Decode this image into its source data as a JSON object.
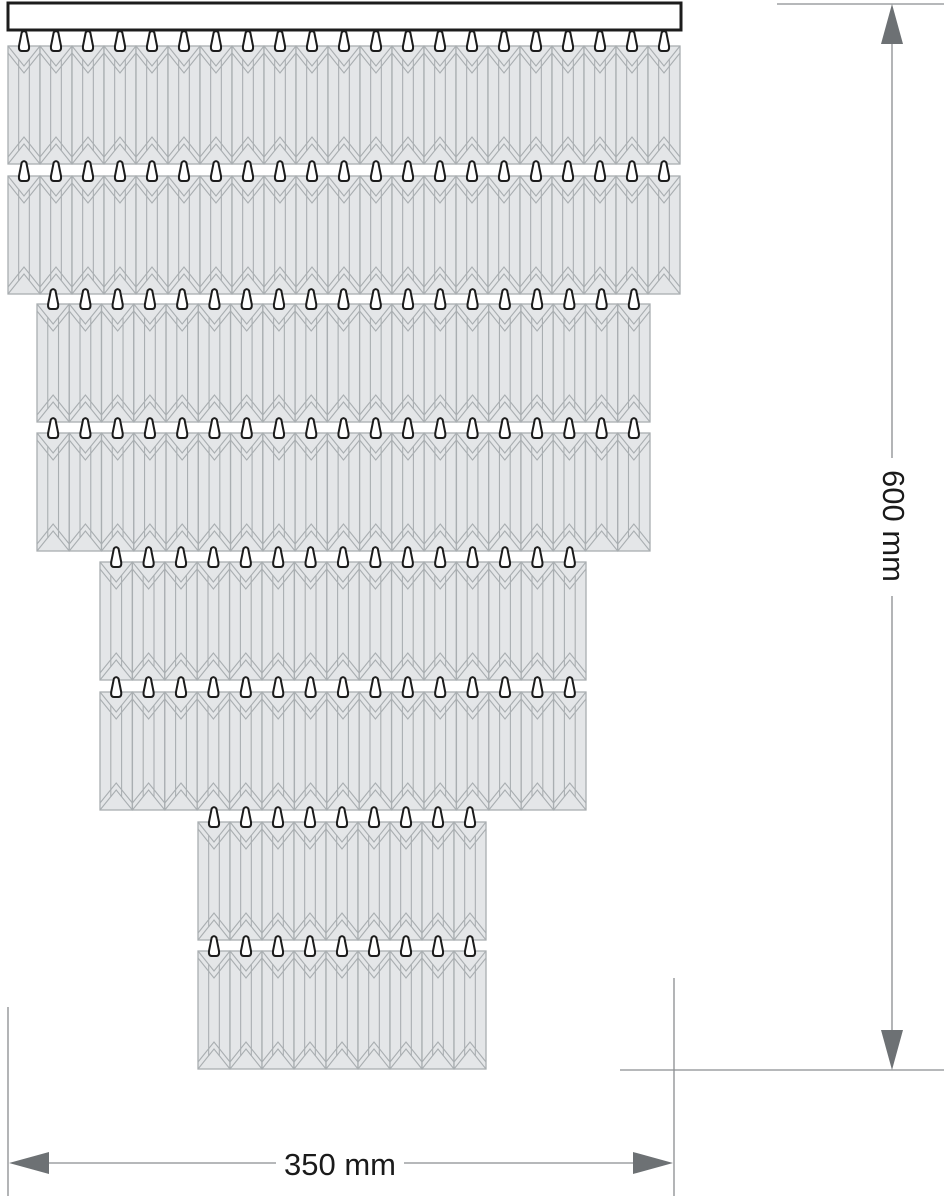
{
  "dimensions": {
    "height": {
      "label": "600 mm"
    },
    "width": {
      "label": "350 mm"
    }
  },
  "fixture": {
    "bar": {
      "x": 8,
      "y": 3,
      "width": 673,
      "height": 27
    },
    "prism_height": 118,
    "chevron_depth": 20,
    "chevron_inner_offset": 7,
    "hook_height": 21,
    "tiers": [
      {
        "row": 1,
        "prisms": 21,
        "left": 8,
        "width": 672,
        "top": 46
      },
      {
        "row": 2,
        "prisms": 21,
        "left": 8,
        "width": 672,
        "top": 176
      },
      {
        "row": 3,
        "prisms": 19,
        "left": 37,
        "width": 613,
        "top": 304
      },
      {
        "row": 4,
        "prisms": 19,
        "left": 37,
        "width": 613,
        "top": 433
      },
      {
        "row": 5,
        "prisms": 15,
        "left": 100,
        "width": 486,
        "top": 562
      },
      {
        "row": 6,
        "prisms": 15,
        "left": 100,
        "width": 486,
        "top": 692
      },
      {
        "row": 7,
        "prisms": 9,
        "left": 198,
        "width": 288,
        "top": 822
      },
      {
        "row": 8,
        "prisms": 9,
        "left": 198,
        "width": 288,
        "top": 951
      }
    ]
  },
  "annotations": {
    "height_dim": {
      "line_x": 892,
      "tip_top_y": 4,
      "tip_bottom_y": 1070,
      "ext_top": {
        "x1": 777,
        "x2": 944,
        "y": 4
      },
      "ext_bottom": {
        "x1": 620,
        "x2": 944,
        "y": 1070
      },
      "label_center": {
        "x": 894,
        "y": 526
      },
      "label_gap": [
        458,
        596
      ]
    },
    "width_dim": {
      "line_y": 1163,
      "tip_left_x": 9,
      "tip_right_x": 673,
      "ext_left": {
        "x": 8,
        "y1": 1007,
        "y2": 1196
      },
      "ext_right": {
        "x": 674,
        "y1": 978,
        "y2": 1196
      },
      "label_center": {
        "x": 340,
        "y": 1164
      },
      "label_gap": [
        276,
        404
      ]
    },
    "arrow": {
      "length": 40,
      "half_width": 11
    }
  },
  "colors": {
    "background": "#ffffff",
    "prism_fill": "#e4e6e8",
    "facet_line": "#a9aeb1",
    "outline_dark": "#1c1c1c",
    "hook_fill": "#ffffff",
    "dimension_line": "#8a8d90",
    "arrow_fill": "#6d7174",
    "label_text": "#1a1a1a"
  }
}
